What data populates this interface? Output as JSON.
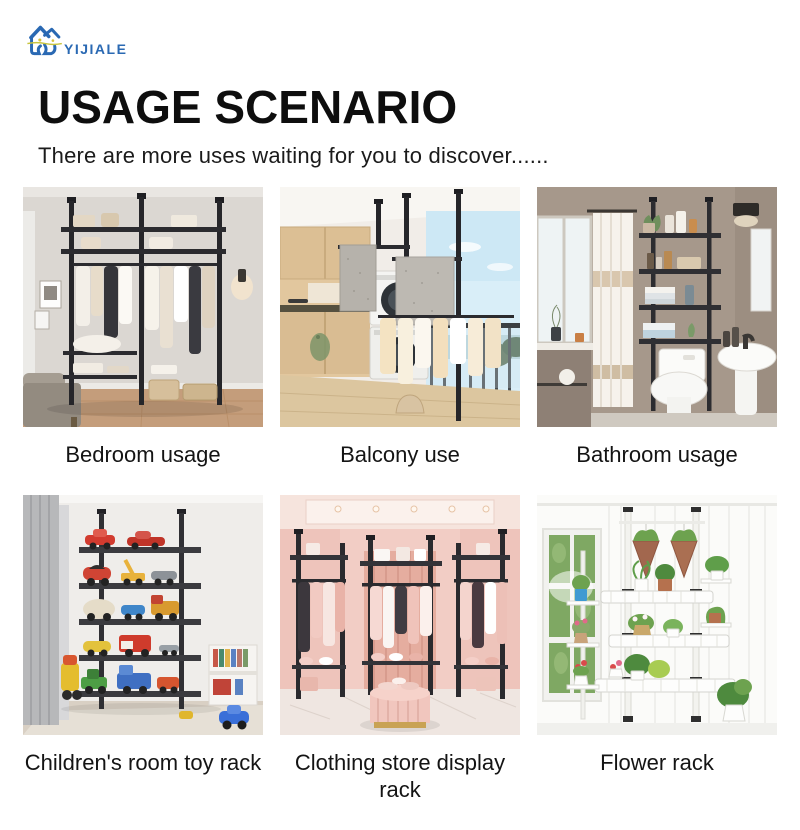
{
  "brand": {
    "name": "YIJIALE"
  },
  "header": {
    "title": "USAGE SCENARIO",
    "subtitle": "There are more uses waiting for you to discover......"
  },
  "cards": [
    {
      "caption": "Bedroom usage",
      "scene": "bedroom-clothes-rack"
    },
    {
      "caption": "Balcony use",
      "scene": "balcony-drying-rack"
    },
    {
      "caption": "Bathroom usage",
      "scene": "over-toilet-shelf"
    },
    {
      "caption": "Children's room toy rack",
      "scene": "toy-car-shelf"
    },
    {
      "caption": "Clothing store display rack",
      "scene": "boutique-corner-racks"
    },
    {
      "caption": "Flower rack",
      "scene": "plant-pole-rack"
    }
  ],
  "colors": {
    "brand_blue": "#2a69b3",
    "logo_accent_yellow": "#c8c43e",
    "heading": "#0e0e0e",
    "caption": "#141414",
    "background": "#ffffff"
  }
}
